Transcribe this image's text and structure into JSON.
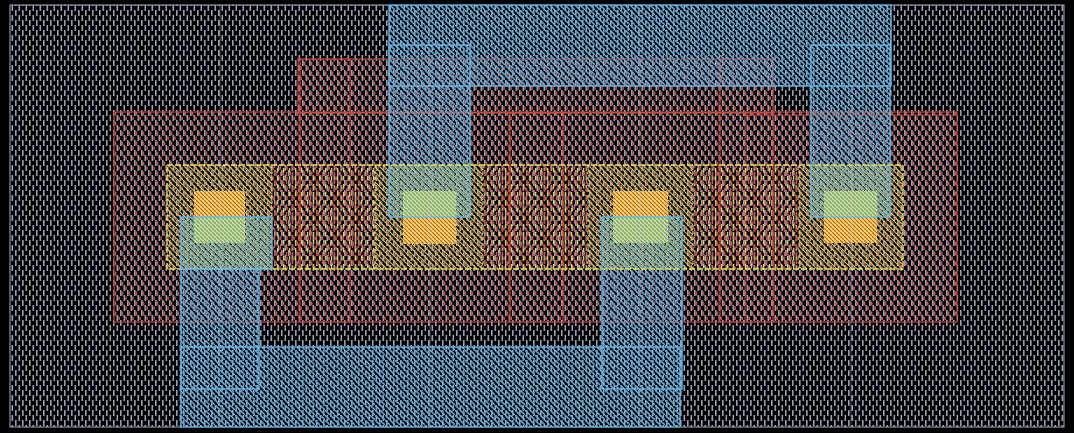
{
  "app": {
    "title": "layout-canvas",
    "description": "IC layout canvas with four transistor cells"
  },
  "canvas": {
    "width": 1074,
    "height": 433,
    "background": "#000000"
  },
  "palette": {
    "well_gray": "#98a0b4",
    "well_border": "#a8aec2",
    "metal_blue": "#5caede",
    "metal_border": "#66b8e8",
    "poly_red": "#c5544c",
    "poly_border": "#c64a3e",
    "poly_bright": "#d84337",
    "diff_yellow": "#d8cc52",
    "diff_border": "#eadf55",
    "contact_base": "#e8dc58",
    "contact_red_overlay": "#cc4f40",
    "contact_blue_overlay": "#4ea2d8",
    "seam": "#c3c8da"
  },
  "patterns": [
    {
      "id": "p-gray",
      "w": 7,
      "h": 10,
      "shapes": [
        {
          "kind": "rect",
          "x": 1,
          "y": 0,
          "w": 1.6,
          "h": 6,
          "fill": "#98a0b4"
        },
        {
          "kind": "rect",
          "x": 4.5,
          "y": 5,
          "w": 1.6,
          "h": 5,
          "fill": "#98a0b4"
        },
        {
          "kind": "rect",
          "x": 4.5,
          "y": 0,
          "w": 1.6,
          "h": 1,
          "fill": "#98a0b4"
        }
      ]
    },
    {
      "id": "p-red",
      "w": 7,
      "h": 10,
      "shapes": [
        {
          "kind": "rect",
          "x": 2.8,
          "y": 1.5,
          "w": 1.5,
          "h": 4,
          "fill": "#c5544c"
        },
        {
          "kind": "rect",
          "x": 6.3,
          "y": 6.5,
          "w": 1.5,
          "h": 3.5,
          "fill": "#c5544c"
        },
        {
          "kind": "rect",
          "x": -0.7,
          "y": 6.5,
          "w": 1.5,
          "h": 3.5,
          "fill": "#c5544c"
        }
      ]
    },
    {
      "id": "p-blue",
      "w": 5,
      "h": 5,
      "shapes": [
        {
          "kind": "path",
          "d": "M-1,-1 L6,6",
          "stroke": "#5caede",
          "sw": 1.6
        }
      ]
    },
    {
      "id": "p-yellow",
      "w": 5,
      "h": 5,
      "shapes": [
        {
          "kind": "path",
          "d": "M-1,1 L6,8",
          "stroke": "#d8cc52",
          "sw": 1.1
        },
        {
          "kind": "path",
          "d": "M-1,-4 L6,3",
          "stroke": "#d8cc52",
          "sw": 1.1
        }
      ]
    },
    {
      "id": "p-gate",
      "w": 6,
      "h": 8,
      "shapes": [
        {
          "kind": "rect",
          "x": 0.9,
          "y": 0,
          "w": 1.4,
          "h": 4.5,
          "fill": "#ddd050"
        },
        {
          "kind": "rect",
          "x": 3.9,
          "y": 4,
          "w": 1.4,
          "h": 4,
          "fill": "#c5544c"
        }
      ]
    },
    {
      "id": "p-ct-red",
      "w": 4,
      "h": 4,
      "shapes": [
        {
          "kind": "path",
          "d": "M-1,-1 L5,5",
          "stroke": "#cc4f40",
          "sw": 1.1
        }
      ]
    },
    {
      "id": "p-ct-blue",
      "w": 4,
      "h": 4,
      "shapes": [
        {
          "kind": "path",
          "d": "M-1,-1 L5,5",
          "stroke": "#4ea2d8",
          "sw": 1.3
        }
      ]
    }
  ],
  "shapes": [
    {
      "name": "well-background",
      "layer": "well",
      "x": 10,
      "y": 5,
      "w": 1054,
      "h": 422,
      "fill": "url(#p-gray)",
      "stroke": "#a8aec2",
      "sw": 1
    },
    {
      "name": "poly-band-main",
      "layer": "poly",
      "x": 114,
      "y": 112,
      "w": 843,
      "h": 210,
      "fill": "url(#p-red)",
      "stroke": "#c64a3e",
      "sw": 1.2
    },
    {
      "name": "poly-top-strap",
      "layer": "poly",
      "x": 298,
      "y": 59,
      "w": 475,
      "h": 54,
      "fill": "url(#p-red)",
      "stroke": "#c64a3e",
      "sw": 1.2
    },
    {
      "name": "poly-right-block",
      "layer": "poly",
      "x": 745,
      "y": 115,
      "w": 212,
      "h": 207,
      "fill": "url(#p-red)",
      "stroke": "#c64a3e",
      "sw": 1
    },
    {
      "name": "poly-gate-1",
      "layer": "poly",
      "x": 300,
      "y": 59,
      "w": 50,
      "h": 263,
      "fill": "url(#p-red)",
      "stroke": "#d84337",
      "sw": 1.2
    },
    {
      "name": "poly-gate-2",
      "layer": "poly",
      "x": 510,
      "y": 113,
      "w": 53,
      "h": 209,
      "fill": "url(#p-red)",
      "stroke": "#d84337",
      "sw": 1.2
    },
    {
      "name": "poly-gate-3",
      "layer": "poly",
      "x": 720,
      "y": 59,
      "w": 53,
      "h": 263,
      "fill": "url(#p-red)",
      "stroke": "#d84337",
      "sw": 1.2
    },
    {
      "name": "diff-segment-1",
      "layer": "diff",
      "x": 167,
      "y": 165,
      "w": 105,
      "h": 104,
      "fill": "url(#p-yellow)"
    },
    {
      "name": "gate-segment-1",
      "layer": "diff",
      "x": 272,
      "y": 165,
      "w": 103,
      "h": 104,
      "fill": "url(#p-gate)"
    },
    {
      "name": "diff-segment-2",
      "layer": "diff",
      "x": 375,
      "y": 165,
      "w": 108,
      "h": 104,
      "fill": "url(#p-yellow)"
    },
    {
      "name": "gate-segment-2",
      "layer": "diff",
      "x": 483,
      "y": 165,
      "w": 105,
      "h": 104,
      "fill": "url(#p-gate)"
    },
    {
      "name": "diff-segment-3",
      "layer": "diff",
      "x": 588,
      "y": 165,
      "w": 105,
      "h": 104,
      "fill": "url(#p-yellow)"
    },
    {
      "name": "gate-segment-3",
      "layer": "diff",
      "x": 693,
      "y": 165,
      "w": 106,
      "h": 104,
      "fill": "url(#p-gate)"
    },
    {
      "name": "diff-segment-4",
      "layer": "diff",
      "x": 799,
      "y": 165,
      "w": 104,
      "h": 104,
      "fill": "url(#p-yellow)"
    },
    {
      "name": "metal-top-rail",
      "layer": "metal",
      "x": 389,
      "y": 5,
      "w": 502,
      "h": 81,
      "fill": "url(#p-blue)"
    },
    {
      "name": "metal-stub-2",
      "layer": "metal",
      "x": 389,
      "y": 45,
      "w": 81,
      "h": 172,
      "fill": "url(#p-blue)"
    },
    {
      "name": "metal-stub-4",
      "layer": "metal",
      "x": 811,
      "y": 45,
      "w": 79,
      "h": 172,
      "fill": "url(#p-blue)"
    },
    {
      "name": "metal-pad-1",
      "layer": "metal",
      "x": 181,
      "y": 217,
      "w": 91,
      "h": 52,
      "fill": "url(#p-blue)"
    },
    {
      "name": "metal-stub-1",
      "layer": "metal",
      "x": 181,
      "y": 269,
      "w": 78,
      "h": 120,
      "fill": "url(#p-blue)"
    },
    {
      "name": "metal-stub-3",
      "layer": "metal",
      "x": 602,
      "y": 217,
      "w": 80,
      "h": 172,
      "fill": "url(#p-blue)"
    },
    {
      "name": "metal-bottom-rail",
      "layer": "metal",
      "x": 181,
      "y": 347,
      "w": 499,
      "h": 80,
      "fill": "url(#p-blue)"
    },
    {
      "name": "contact-1-base",
      "layer": "contact",
      "x": 194,
      "y": 191,
      "w": 51,
      "h": 52,
      "fill": "#e8dc58"
    },
    {
      "name": "contact-1-top",
      "layer": "contact",
      "x": 194,
      "y": 191,
      "w": 51,
      "h": 26,
      "fill": "url(#p-ct-red)"
    },
    {
      "name": "contact-1-bottom",
      "layer": "contact",
      "x": 194,
      "y": 217,
      "w": 51,
      "h": 26,
      "fill": "url(#p-ct-blue)"
    },
    {
      "name": "contact-2-base",
      "layer": "contact",
      "x": 403,
      "y": 191,
      "w": 53,
      "h": 53,
      "fill": "#e8dc58"
    },
    {
      "name": "contact-2-top",
      "layer": "contact",
      "x": 403,
      "y": 191,
      "w": 53,
      "h": 26,
      "fill": "url(#p-ct-blue)"
    },
    {
      "name": "contact-2-bottom",
      "layer": "contact",
      "x": 403,
      "y": 217,
      "w": 53,
      "h": 27,
      "fill": "url(#p-ct-red)"
    },
    {
      "name": "contact-3-base",
      "layer": "contact",
      "x": 613,
      "y": 191,
      "w": 55,
      "h": 52,
      "fill": "#e8dc58"
    },
    {
      "name": "contact-3-top",
      "layer": "contact",
      "x": 613,
      "y": 191,
      "w": 55,
      "h": 26,
      "fill": "url(#p-ct-red)"
    },
    {
      "name": "contact-3-bottom",
      "layer": "contact",
      "x": 613,
      "y": 217,
      "w": 55,
      "h": 26,
      "fill": "url(#p-ct-blue)"
    },
    {
      "name": "contact-4-base",
      "layer": "contact",
      "x": 824,
      "y": 191,
      "w": 53,
      "h": 52,
      "fill": "#e8dc58"
    },
    {
      "name": "contact-4-top",
      "layer": "contact",
      "x": 824,
      "y": 191,
      "w": 53,
      "h": 26,
      "fill": "url(#p-ct-blue)"
    },
    {
      "name": "contact-4-bottom",
      "layer": "contact",
      "x": 824,
      "y": 217,
      "w": 53,
      "h": 26,
      "fill": "url(#p-ct-red)"
    },
    {
      "name": "diff-band-border",
      "layer": "border",
      "x": 167,
      "y": 165,
      "w": 736,
      "h": 104,
      "fill": "none",
      "stroke": "#eadf55",
      "sw": 1.4,
      "dash": "6,2"
    },
    {
      "name": "diff-divider-1",
      "layer": "border",
      "line": [
        272,
        165,
        272,
        269
      ],
      "stroke": "#eadf55",
      "sw": 1,
      "dash": "3,3"
    },
    {
      "name": "diff-divider-2",
      "layer": "border",
      "line": [
        375,
        165,
        375,
        269
      ],
      "stroke": "#eadf55",
      "sw": 1,
      "dash": "3,3"
    },
    {
      "name": "diff-divider-3",
      "layer": "border",
      "line": [
        483,
        165,
        483,
        269
      ],
      "stroke": "#eadf55",
      "sw": 1,
      "dash": "3,3"
    },
    {
      "name": "diff-divider-4",
      "layer": "border",
      "line": [
        588,
        165,
        588,
        269
      ],
      "stroke": "#eadf55",
      "sw": 1,
      "dash": "3,3"
    },
    {
      "name": "diff-divider-5",
      "layer": "border",
      "line": [
        693,
        165,
        693,
        269
      ],
      "stroke": "#eadf55",
      "sw": 1,
      "dash": "3,3"
    },
    {
      "name": "diff-divider-6",
      "layer": "border",
      "line": [
        799,
        165,
        799,
        269
      ],
      "stroke": "#eadf55",
      "sw": 1,
      "dash": "3,3"
    },
    {
      "name": "metal-top-rail-border",
      "layer": "border",
      "x": 389,
      "y": 5,
      "w": 502,
      "h": 81,
      "fill": "none",
      "stroke": "#66b8e8",
      "sw": 1.4
    },
    {
      "name": "metal-stub-2-border",
      "layer": "border",
      "x": 389,
      "y": 45,
      "w": 81,
      "h": 172,
      "fill": "none",
      "stroke": "#66b8e8",
      "sw": 1.4
    },
    {
      "name": "metal-stub-4-border",
      "layer": "border",
      "x": 811,
      "y": 45,
      "w": 79,
      "h": 172,
      "fill": "none",
      "stroke": "#66b8e8",
      "sw": 1.4
    },
    {
      "name": "metal-pad-1-border",
      "layer": "border",
      "x": 181,
      "y": 217,
      "w": 91,
      "h": 52,
      "fill": "none",
      "stroke": "#66b8e8",
      "sw": 1.4
    },
    {
      "name": "metal-stub-1-border",
      "layer": "border",
      "x": 181,
      "y": 269,
      "w": 78,
      "h": 120,
      "fill": "none",
      "stroke": "#66b8e8",
      "sw": 1.4
    },
    {
      "name": "metal-stub-3-border",
      "layer": "border",
      "x": 602,
      "y": 217,
      "w": 80,
      "h": 172,
      "fill": "none",
      "stroke": "#66b8e8",
      "sw": 1.4
    },
    {
      "name": "metal-bottom-rail-border",
      "layer": "border",
      "x": 181,
      "y": 347,
      "w": 499,
      "h": 80,
      "fill": "none",
      "stroke": "#66b8e8",
      "sw": 1.4
    },
    {
      "name": "cell-seam-1",
      "layer": "seam",
      "line": [
        220,
        5,
        220,
        427
      ],
      "stroke": "#c3c8da",
      "sw": 1,
      "opacity": 0.4
    },
    {
      "name": "cell-seam-2",
      "layer": "seam",
      "line": [
        430,
        5,
        430,
        427
      ],
      "stroke": "#c3c8da",
      "sw": 1,
      "opacity": 0.4
    },
    {
      "name": "cell-seam-3",
      "layer": "seam",
      "line": [
        640,
        5,
        640,
        427
      ],
      "stroke": "#c3c8da",
      "sw": 1,
      "opacity": 0.4
    },
    {
      "name": "cell-seam-4",
      "layer": "seam",
      "line": [
        851,
        5,
        851,
        427
      ],
      "stroke": "#c3c8da",
      "sw": 1,
      "opacity": 0.4
    }
  ]
}
